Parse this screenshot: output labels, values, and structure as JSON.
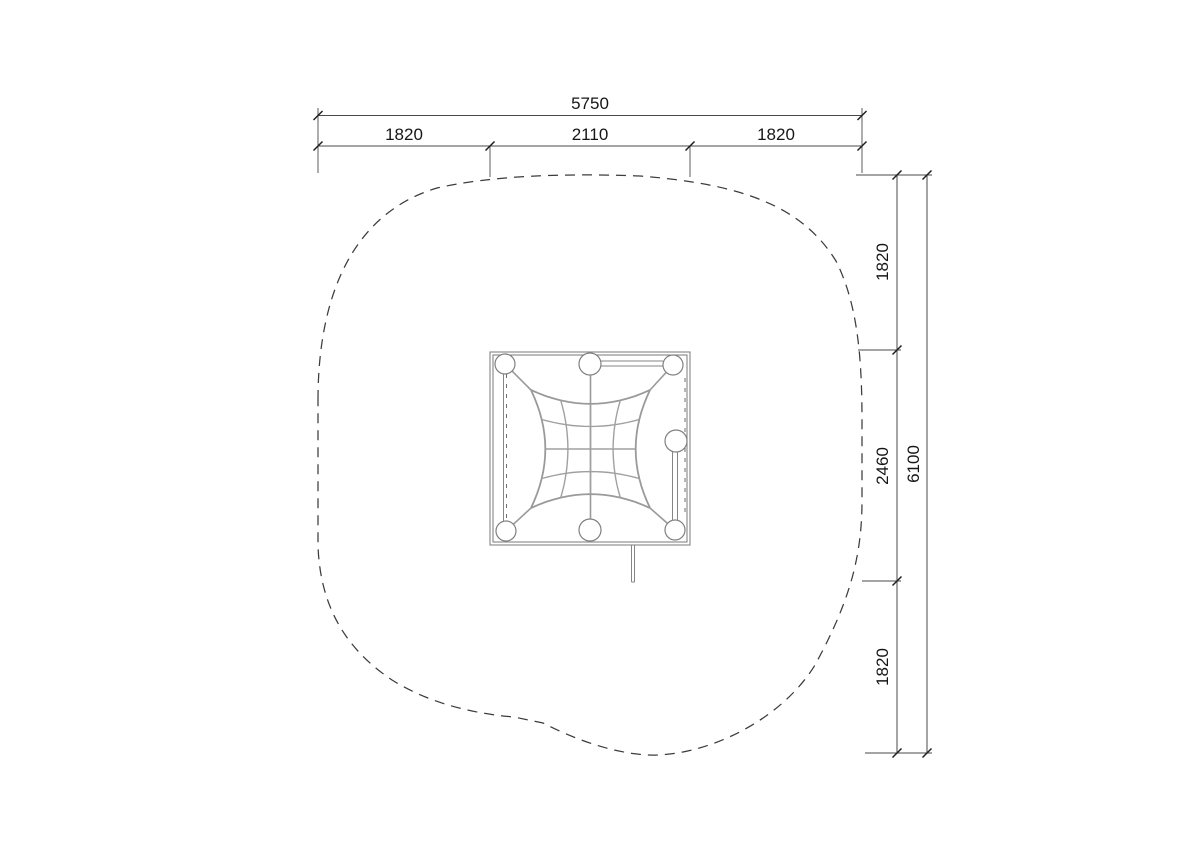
{
  "drawing": {
    "dimensions_top": {
      "total": "5750",
      "segment_left": "1820",
      "segment_middle": "2110",
      "segment_right": "1820"
    },
    "dimensions_right": {
      "total": "6100",
      "segment_top": "1820",
      "segment_middle": "2460",
      "segment_bottom": "1820"
    }
  },
  "colors": {
    "background": "#ffffff",
    "dimension_lines": "#4a4a4a",
    "dimension_text": "#161616",
    "safety_boundary": "#3c3c3c",
    "structure_frame": "#858585",
    "net_rope": "#9a9a9a"
  }
}
